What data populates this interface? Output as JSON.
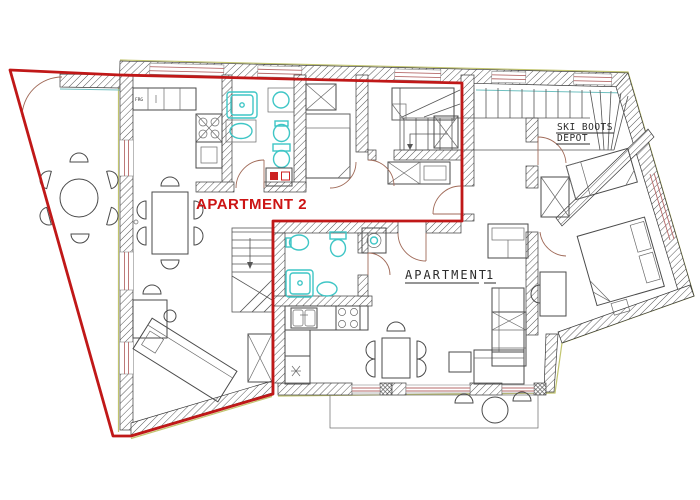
{
  "plan": {
    "labels": {
      "apartment2": "APARTMENT 2",
      "apartment1_word": "APARTMENT",
      "apartment1_number": "1",
      "ski_depot_line1": "SKI BOOTS",
      "ski_depot_line2": "DEPOT",
      "fridge": "FRG"
    },
    "colors": {
      "apartment2_boundary": "#c01818",
      "apartment2_label_text": "#cc1414",
      "sanitary_fixtures": "#3fc6c6",
      "walls": "#3a3a3a",
      "window_lines": "#b66a6a",
      "outer_contour": "#c2c56f"
    },
    "icons": [
      "round-table-icon",
      "dining-table-icon",
      "chair-icon",
      "bed-icon",
      "wardrobe-icon",
      "shower-icon",
      "toilet-icon",
      "bidet-icon",
      "sink-icon",
      "washing-machine-icon",
      "stairs-icon",
      "sofa-icon",
      "chaise-icon",
      "desk-icon",
      "stove-icon",
      "fridge-icon",
      "door-swing-icon",
      "balcony-icon"
    ]
  }
}
